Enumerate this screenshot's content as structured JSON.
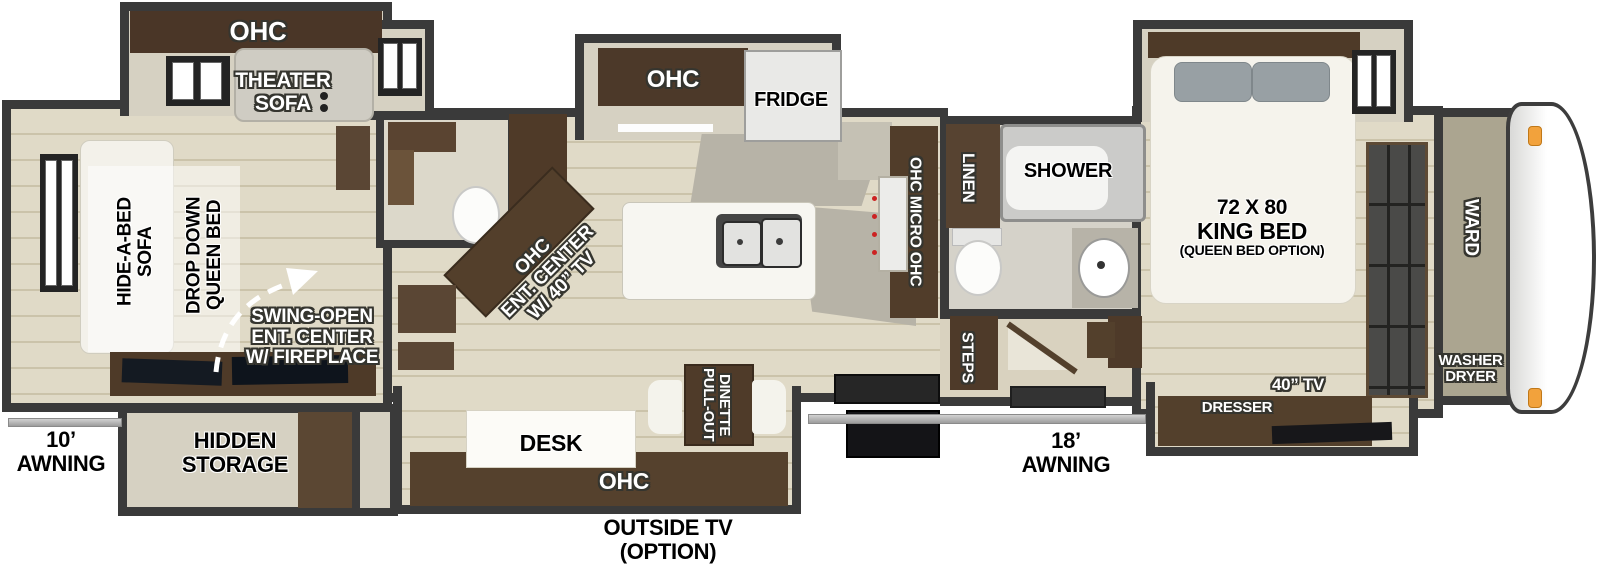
{
  "rear": {
    "ohc_label": "OHC",
    "theater_sofa": "THEATER\nSOFA",
    "hide_a_bed": "HIDE-A-BED\nSOFA",
    "drop_down_bed": "DROP DOWN\nQUEEN BED",
    "swing_open": "SWING-OPEN\nENT. CENTER\nW/ FIREPLACE",
    "hidden_storage": "HIDDEN\nSTORAGE",
    "awning": "10’\nAWNING"
  },
  "kitchen": {
    "ohc_top": "OHC",
    "fridge": "FRIDGE",
    "ent_center": "OHC\nENT. CENTER\nW/ 40” TV",
    "pantry_column": "OHC MICRO OHC",
    "desk": "DESK",
    "ohc_bottom": "OHC",
    "dinette": "PULL-OUT\nDINETTE",
    "outside_tv": "OUTSIDE TV\n(OPTION)"
  },
  "bath": {
    "linen": "LINEN",
    "shower": "SHOWER"
  },
  "entry": {
    "steps": "STEPS",
    "awning": "18’\nAWNING"
  },
  "bedroom": {
    "bed_size": "72 X 80",
    "bed_type": "KING BED",
    "bed_option": "(QUEEN BED OPTION)",
    "tv": "40” TV",
    "dresser": "DRESSER"
  },
  "front": {
    "ward": "WARD",
    "washer_dryer": "WASHER\nDRYER"
  },
  "colors": {
    "wall": "#3a3a3a",
    "cabinet": "#4e3a28",
    "floor_light": "#ddd6c1",
    "awning_bar": "#b9b9b9",
    "clearance_light": "#f2a23c",
    "front_cap": "#ffffff"
  }
}
